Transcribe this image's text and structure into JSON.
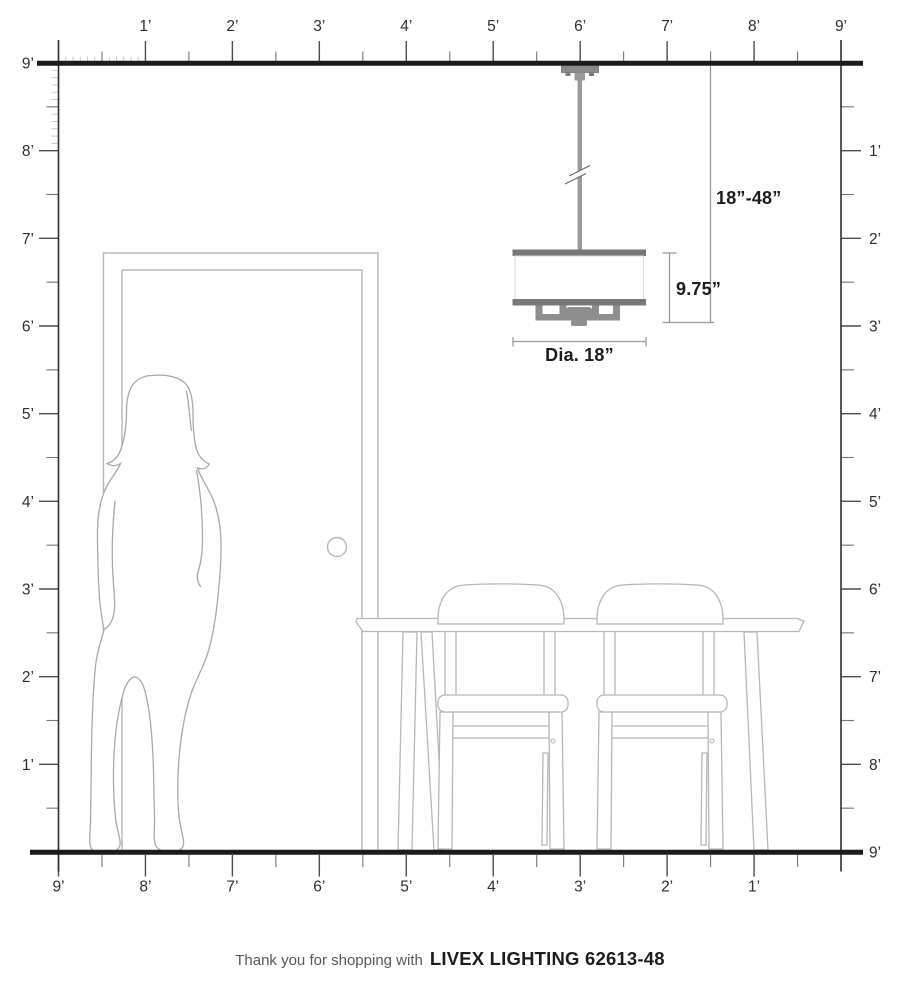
{
  "footer": {
    "prefix": "Thank you for shopping with",
    "brand": "LIVEX LIGHTING 62613-48"
  },
  "dimensions": {
    "hang_range": "18”-48”",
    "fixture_height": "9.75”",
    "diameter": "Dia. 18”"
  },
  "rulers": {
    "top": [
      "1’",
      "2’",
      "3’",
      "4’",
      "5’",
      "6’",
      "7’",
      "8’",
      "9’"
    ],
    "bottom": [
      "9’",
      "8’",
      "7’",
      "6’",
      "5’",
      "4’",
      "3’",
      "2’",
      "1’"
    ],
    "left": [
      "9’",
      "8’",
      "7’",
      "6’",
      "5’",
      "4’",
      "3’",
      "2’",
      "1’"
    ],
    "right": [
      "1’",
      "2’",
      "3’",
      "4’",
      "5’",
      "6’",
      "7’",
      "8’",
      "9’"
    ]
  },
  "colors": {
    "wall_line": "#1b1b1b",
    "tick_major": "#4d4d4d",
    "tick_half": "#757575",
    "tick_fine": "#c4c4c4",
    "fixture_gray": "#8e8e8e",
    "rim_gray": "#787878",
    "rod_gray": "#9b9b9b",
    "outline_gray": "#b7b7b7",
    "dim_line": "#9a9a9a"
  }
}
